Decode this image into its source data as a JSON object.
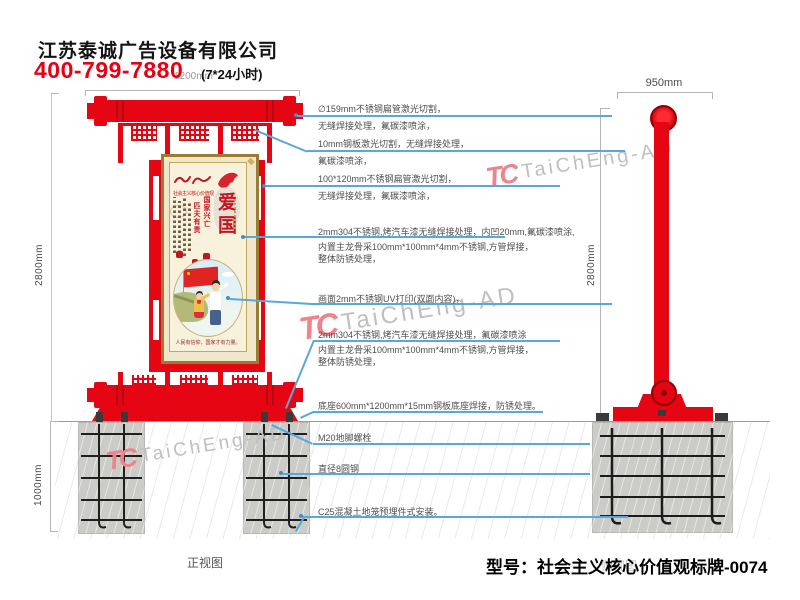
{
  "header": {
    "company": "江苏泰诚广告设备有限公司",
    "phone": "400-799-7880",
    "hours": "(7*24小时)"
  },
  "dimensions": {
    "front_top_width": "1200mm",
    "front_height": "2800mm",
    "foundation_depth": "1000mm",
    "side_width": "950mm",
    "side_height": "2800mm"
  },
  "poster": {
    "slogan": "社会主义核心价值观",
    "motto_col1": "国家兴亡",
    "motto_col2": "匹夫有责",
    "big_chars": "爱国",
    "caption": "人民有信仰，国家才有力量。"
  },
  "annotations": [
    {
      "lines": [
        "∅159mm不锈钢扁管激光切割，",
        "无缝焊接处理，氟碳漆喷涂，"
      ]
    },
    {
      "lines": [
        "10mm钢板激光切割，无缝焊接处理，",
        "氟碳漆喷涂，"
      ]
    },
    {
      "lines": [
        "100*120mm不锈钢扁管激光切割，",
        "无缝焊接处理，氟碳漆喷涂，"
      ]
    },
    {
      "lines": [
        "2mm304不锈钢,烤汽车漆无缝焊接处理，内凹20mm,氟碳漆喷涂,",
        "内置主龙骨采100mm*100mm*4mm不锈钢,方管焊接，",
        "整体防锈处理，"
      ]
    },
    {
      "lines": [
        "画面2mm不锈钢UV打印(双面内容)，"
      ]
    },
    {
      "lines": [
        "2mm304不锈钢,烤汽车漆无缝焊接处理，氟碳漆喷涂",
        "内置主龙骨采100mm*100mm*4mm不锈钢,方管焊接，",
        "整体防锈处理，"
      ]
    },
    {
      "lines": [
        "底座600mm*1200mm*15mm钢板底座焊接，防锈处理。"
      ]
    },
    {
      "lines": [
        "M20地脚螺栓"
      ]
    },
    {
      "lines": [
        "直径8圆钢"
      ]
    },
    {
      "lines": [
        "C25混凝土地笼预埋件式安装。"
      ]
    }
  ],
  "footer": {
    "front_view_label": "正视图",
    "side_view_label": "侧视图",
    "model": "型号：社会主义核心价值观标牌-0074"
  },
  "watermark": {
    "logo": "TC",
    "text": "TaiChEng-AD"
  },
  "colors": {
    "sign_red": "#e60613",
    "annotation_blue": "#56a9da",
    "phone_red": "#e60012"
  }
}
